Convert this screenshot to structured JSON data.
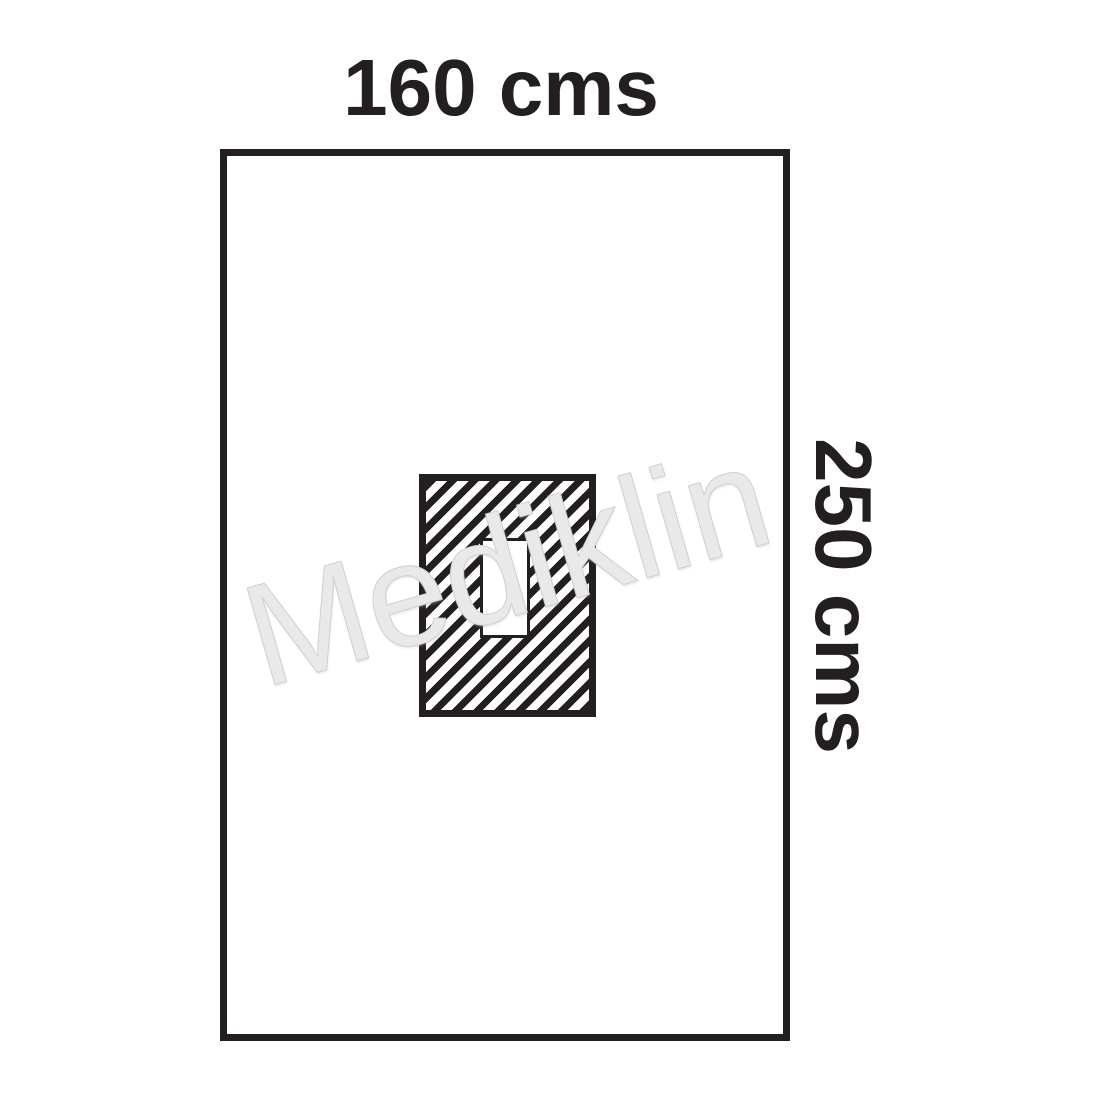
{
  "diagram": {
    "type": "surgical-drape-dimension-diagram",
    "width_label": "160 cms",
    "height_label": "250 cms",
    "watermark": "Mediklin",
    "drape": {
      "width_cms": 160,
      "height_cms": 250
    },
    "features": {
      "adhesive_aperture_area": "hatched rectangle centered on drape",
      "fenestration": "small white rectangular opening inside hatched area"
    }
  },
  "colors": {
    "background": "#ffffff",
    "line": "#231f20",
    "watermark_fill": "#e9e9e9",
    "watermark_edge": "#d0d0d0"
  }
}
